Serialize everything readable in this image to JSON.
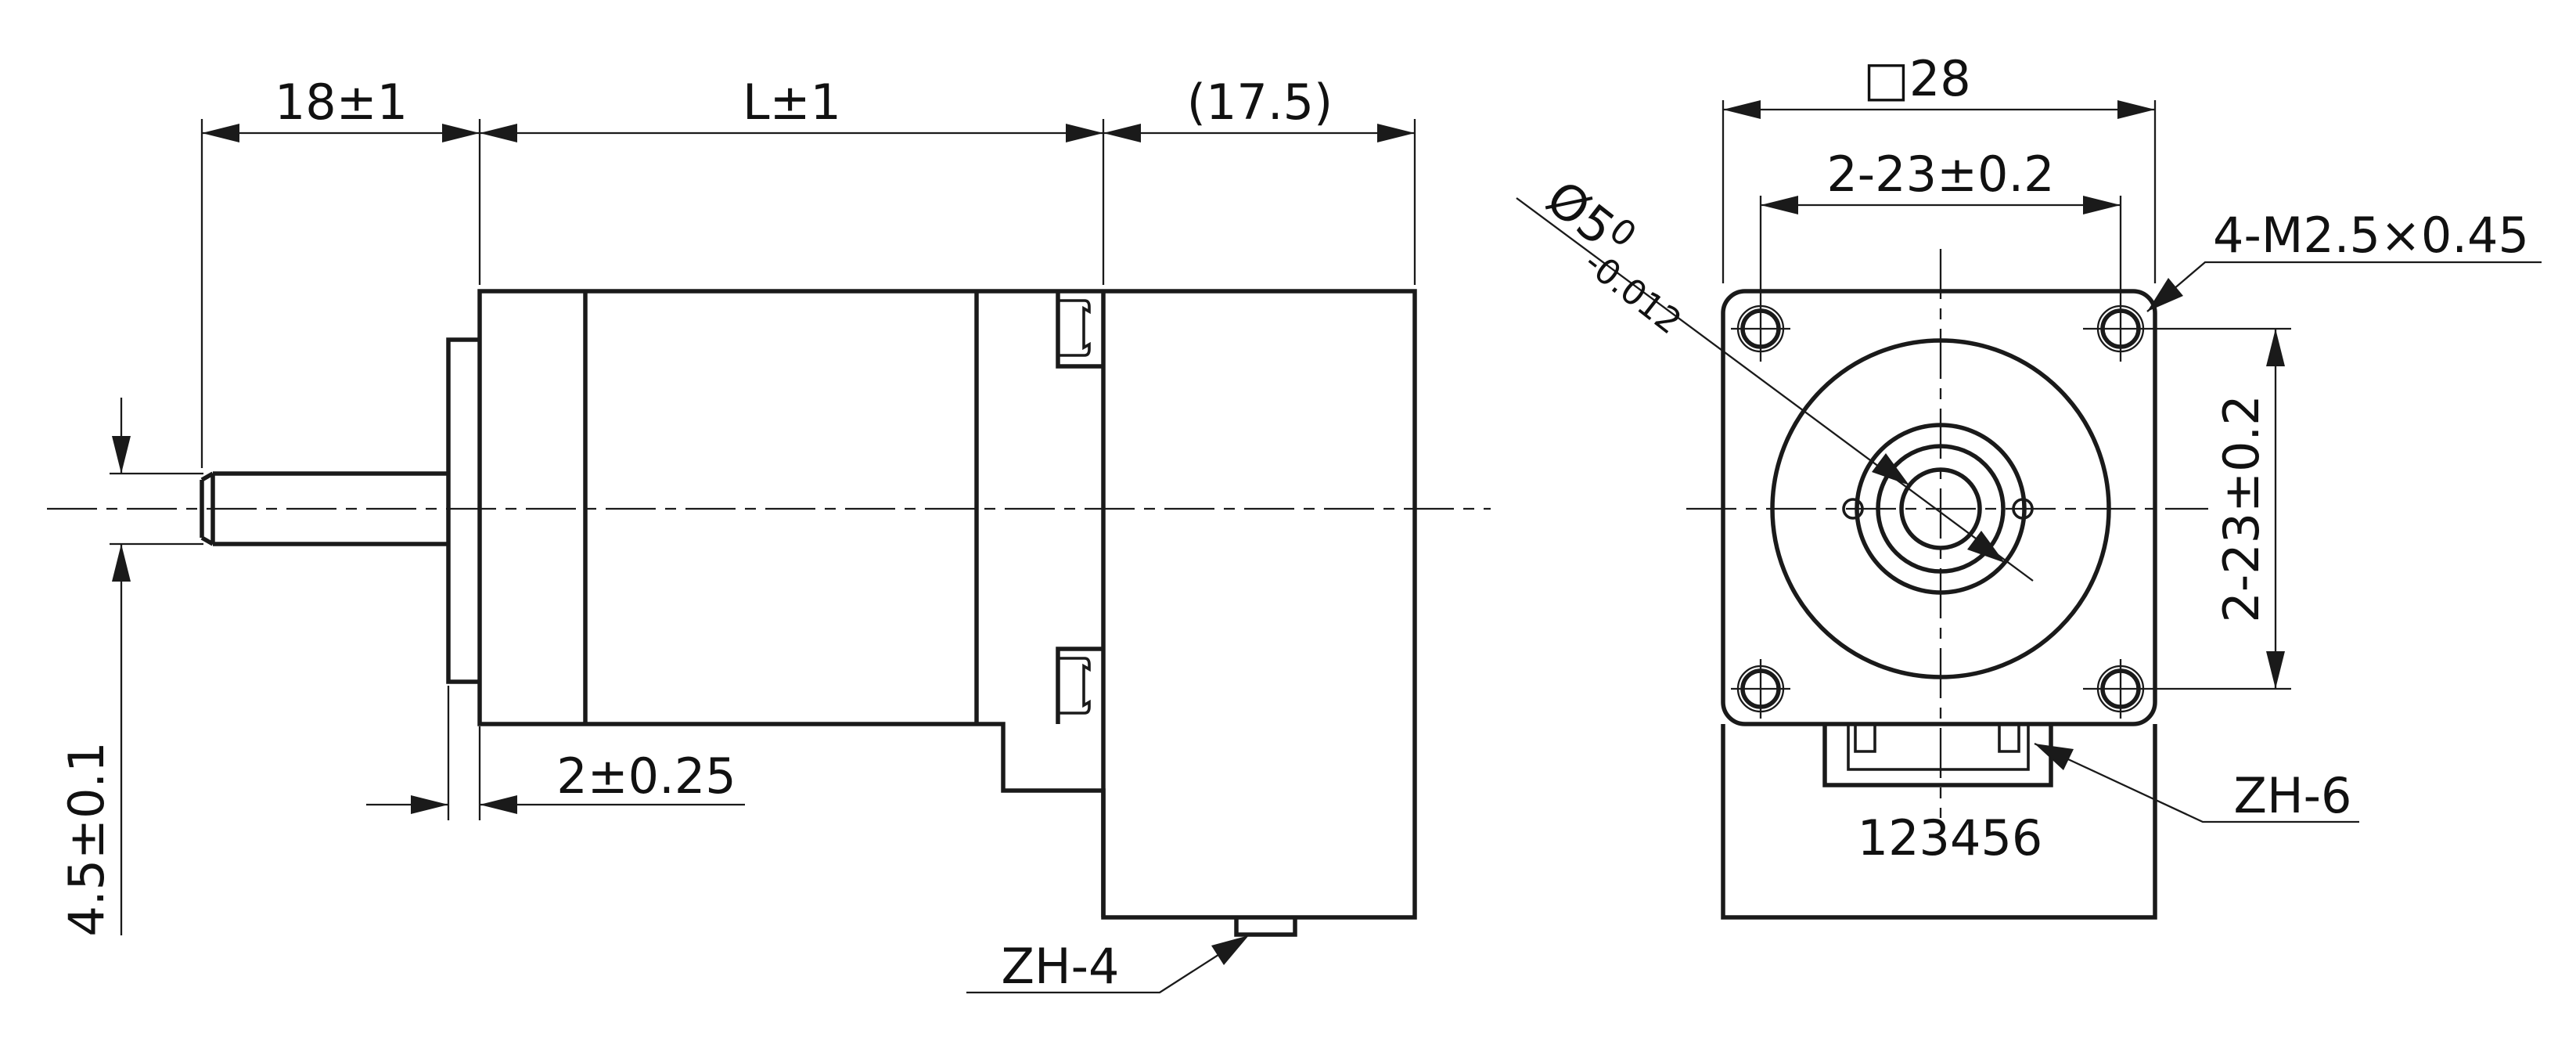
{
  "page": {
    "background": "#ffffff",
    "line_color": "#1a1a1a",
    "text_color": "#111111"
  },
  "side_view": {
    "dim_shaft_length": "18±1",
    "dim_body_length": "L±1",
    "dim_rear_length": "(17.5)",
    "dim_shaft_flat": "4.5±0.1",
    "dim_boss_thickness": "2±0.25",
    "connector_label": "ZH-4"
  },
  "front_view": {
    "dim_flange_size": "□28",
    "dim_hole_spacing_horizontal": "2-23±0.2",
    "dim_hole_spacing_vertical": "2-23±0.2",
    "dim_mounting_thread": "4-M2.5×0.45",
    "dim_shaft_diameter": "Ø5",
    "dim_shaft_diameter_upper_tol": "0",
    "dim_shaft_diameter_lower_tol": "-0.012",
    "connector_label": "ZH-6",
    "connector_pin_numbers": "123456"
  }
}
